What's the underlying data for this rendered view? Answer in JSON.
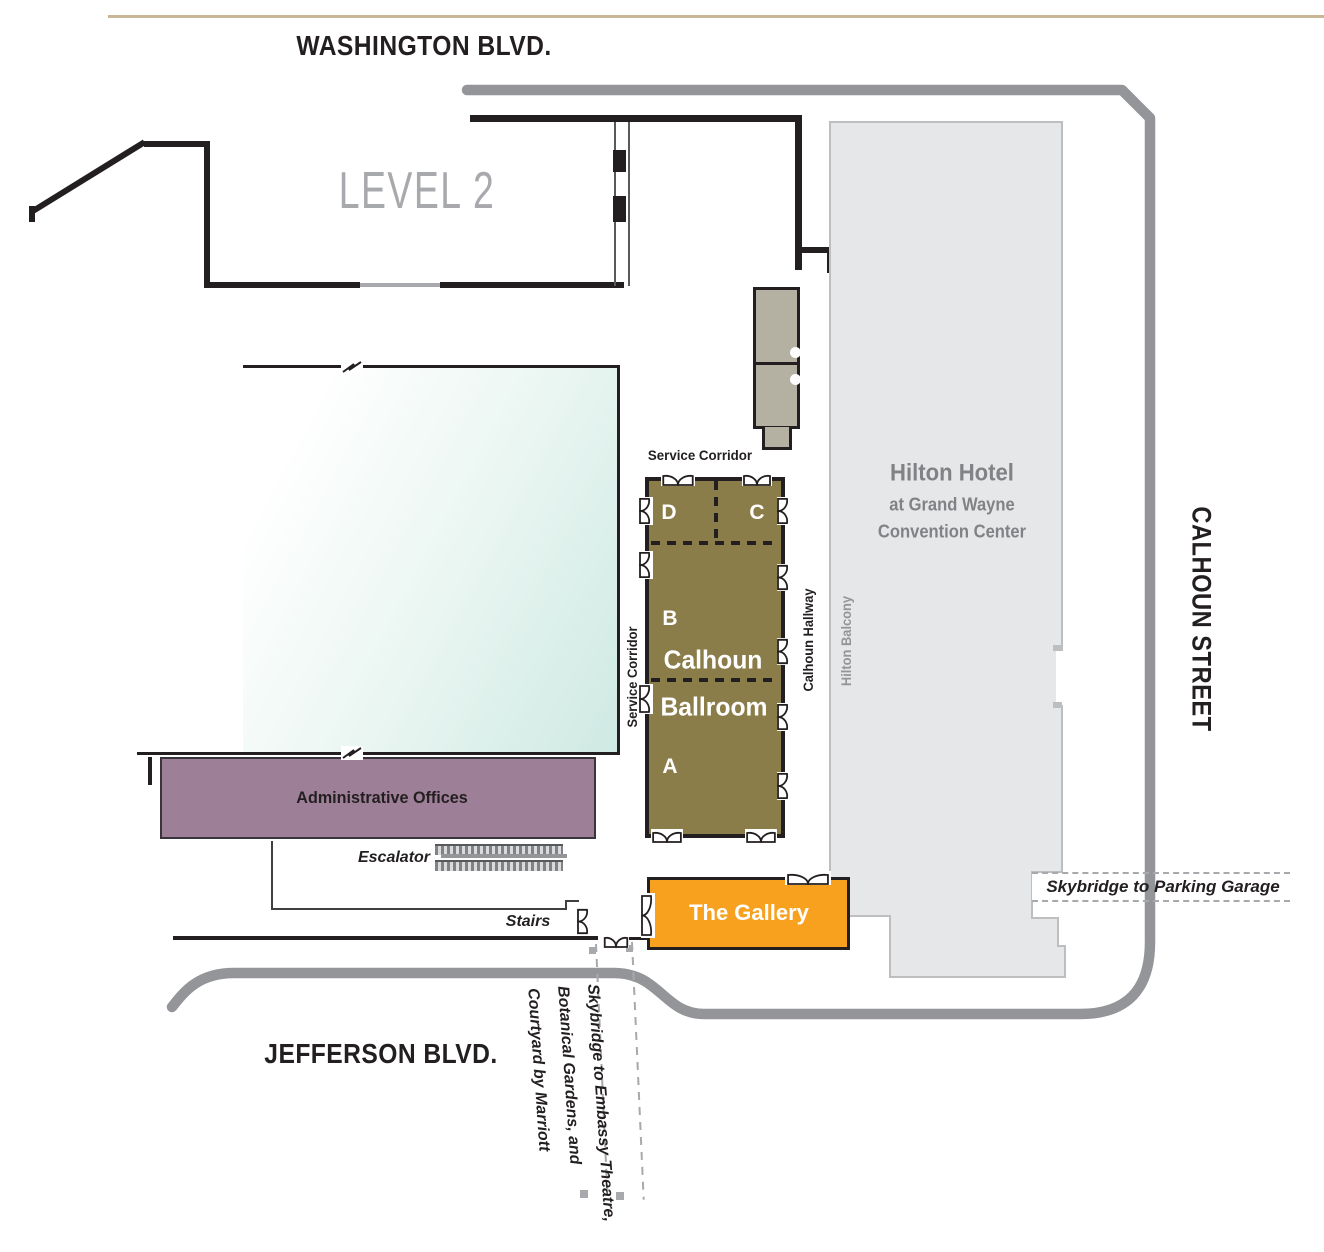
{
  "level_label": "LEVEL 2",
  "streets": {
    "washington": "WASHINGTON BLVD.",
    "jefferson": "JEFFERSON BLVD.",
    "calhoun": "CALHOUN STREET"
  },
  "hotel": {
    "name_line1": "Hilton Hotel",
    "name_line2": "at Grand Wayne",
    "name_line3": "Convention Center",
    "balcony": "Hilton Balcony"
  },
  "ballroom": {
    "name_line1": "Calhoun",
    "name_line2": "Ballroom",
    "section_a": "A",
    "section_b": "B",
    "section_c": "C",
    "section_d": "D",
    "hallway": "Calhoun Hallway",
    "service_corridor_top": "Service Corridor",
    "service_corridor_left": "Service Corridor"
  },
  "rooms": {
    "administrative_offices": "Administrative Offices",
    "gallery": "The Gallery"
  },
  "circulation": {
    "escalator": "Escalator",
    "stairs": "Stairs"
  },
  "skybridges": {
    "parking": "Skybridge to Parking Garage",
    "south_line1": "Skybridge to Embassy Theatre,",
    "south_line2": "Botanical Gardens, and",
    "south_line3": "Courtyard by Marriott"
  },
  "colors": {
    "ballroom": "#8b7d4a",
    "administrative_offices": "#9e7f98",
    "gallery": "#f7a11e",
    "hotel_fill": "#e6e7e8",
    "road": "#939598",
    "exhibit_hall_teal": "#cfe9e3",
    "top_rule_tan": "#c8b697",
    "wall": "#231f20"
  }
}
